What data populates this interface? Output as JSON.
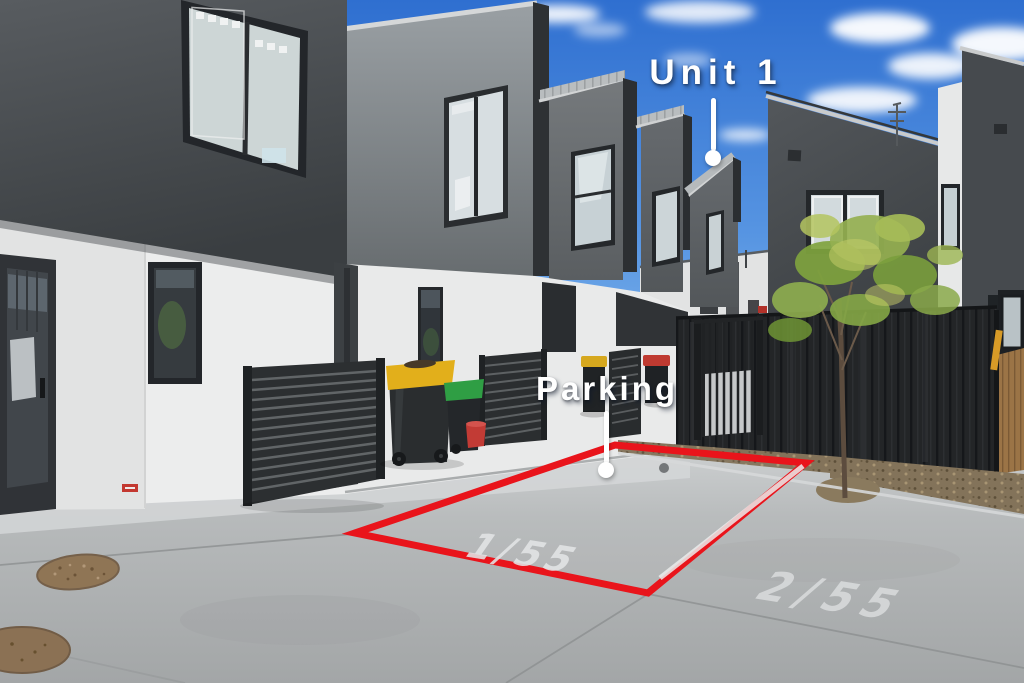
{
  "annotations": {
    "unit": {
      "label": "Unit 1"
    },
    "parking": {
      "label": "Parking"
    }
  },
  "ground_markings": {
    "space_1": "1/55",
    "space_2": "2/55"
  },
  "colors": {
    "sky_top": "#2f6fd0",
    "sky_horizon": "#8ec1ef",
    "parking_outline_red": "#e9141b",
    "road_marking_white": "#e3e5e6",
    "bin_lid_yellow": "#e2af1b",
    "bin_lid_green": "#2f9e44",
    "bin_lid_red": "#bf3a31",
    "bucket_red": "#c23b35",
    "tree_foliage": "#8fae4f",
    "building_dark": "#43474b",
    "building_white": "#e9eaea",
    "fence_black": "#232527",
    "metal_roof": "#b9bdbf",
    "concrete": "#b2b5b6"
  }
}
